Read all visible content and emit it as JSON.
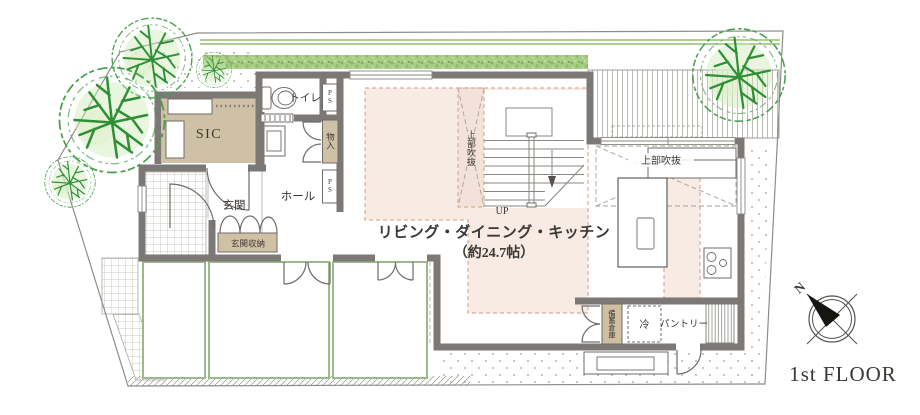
{
  "floor_title": "1st FLOOR",
  "compass": {
    "north": "N"
  },
  "labels": {
    "sic": "SIC",
    "toilet": "トイレ",
    "ps_top": "PS",
    "closet": "物入",
    "ps_bottom": "PS",
    "entrance": "玄関",
    "entrance_storage": "玄関収納",
    "hall": "ホール",
    "void_stair": "上部吹抜",
    "up": "UP",
    "ldk_line1": "リビング・ダイニング・キッチン",
    "ldk_line2": "（約24.7帖）",
    "void_dining": "上部吹抜",
    "stock_storage": "備蓄倉庫",
    "fridge": "冷",
    "pantry": "パントリー"
  },
  "colors": {
    "wall": "#7b7875",
    "room_beige": "#cfc1a5",
    "ldk_highlight": "#f7ebe4",
    "highlight_border": "#dcab98",
    "hedge_green": "#a9cd86",
    "tree_green": "#2e8f35",
    "terrace_border": "#9cb88d"
  }
}
